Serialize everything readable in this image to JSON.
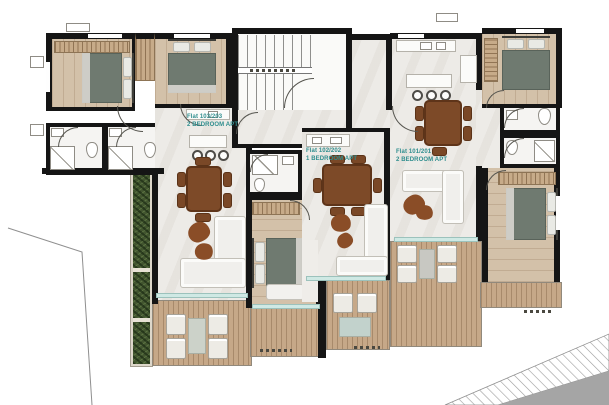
{
  "plan": {
    "flats": [
      {
        "id": "flat-103-203",
        "title": "Flat 103/203",
        "subtitle": "2 BEDROOM APT"
      },
      {
        "id": "flat-102-202",
        "title": "Flat 102/202",
        "subtitle": "1 BEDROOM APT"
      },
      {
        "id": "flat-101-201",
        "title": "Flat 101/201",
        "subtitle": "2 BEDROOM APT"
      }
    ],
    "colors": {
      "accent": "#2f8e8e",
      "wall": "#151515",
      "marble": "#edebe7",
      "wood": "#d3c1a9",
      "deck": "#c6a888",
      "bath": "#f5f4f2",
      "glass": "#cfe9e4",
      "green": "#42552f",
      "furnwood": "#7d4a28",
      "bed": "#6f7a70",
      "sofa": "#f0efec",
      "road_gray": "#a5a5a5"
    }
  }
}
